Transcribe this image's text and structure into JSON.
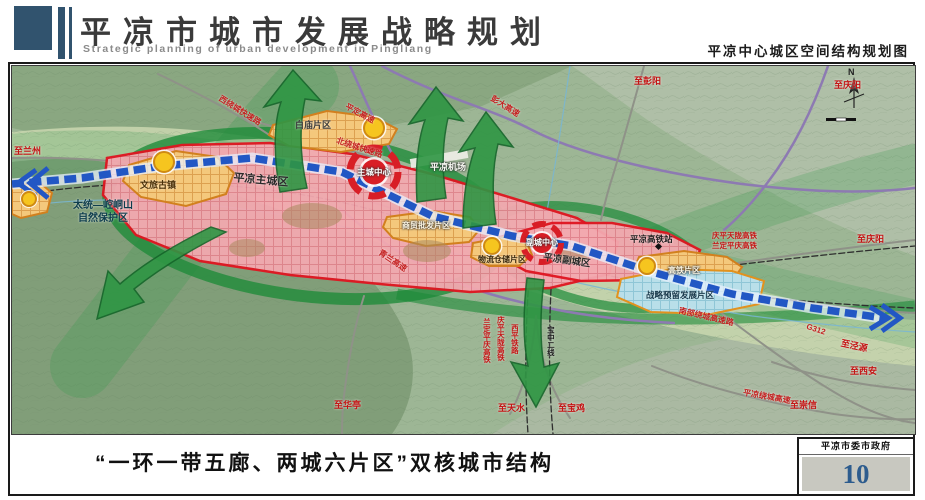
{
  "header": {
    "title": "平凉市城市发展战略规划",
    "subtitle": "Strategic planning of urban development in Pingliang",
    "map_title": "平凉中心城区空间结构规划图"
  },
  "footer": {
    "caption": "“一环一带五廊、两城六片区”双核城市结构",
    "agency": "平凉市委市政府",
    "page_number": "10"
  },
  "map": {
    "compass_n": "N",
    "colors": {
      "header_accent": "#31536e",
      "page_number_blue": "#2d5c8e",
      "main_city_border": "#e01520",
      "district_border": "#d2801e",
      "reserve_fill": "#b9dfe9",
      "axis_blue": "#2257c4",
      "corridor_green": "#2f9644",
      "node_yellow": "#f6c51f"
    },
    "labels": [
      {
        "text": "至兰州",
        "x": 2,
        "y": 80,
        "color": "#c41414",
        "size": 9
      },
      {
        "text": "太统—崆峒山\n自然保护区",
        "x": 48,
        "y": 134,
        "color": "#0e3d4d",
        "size": 10,
        "width": 86,
        "center": 1
      },
      {
        "text": "文旅古镇",
        "x": 128,
        "y": 114,
        "color": "#4a3008",
        "size": 9
      },
      {
        "text": "平凉主城区",
        "x": 222,
        "y": 106,
        "color": "#2a2a2a",
        "size": 11,
        "rotate": 5
      },
      {
        "text": "主城中心",
        "x": 345,
        "y": 101,
        "color": "#ffffff",
        "size": 8.5,
        "halo": 1
      },
      {
        "text": "白庙片区",
        "x": 283,
        "y": 54,
        "color": "#3c3c3c",
        "size": 9
      },
      {
        "text": "西绕城快速路",
        "x": 210,
        "y": 28,
        "color": "#c42020",
        "size": 8,
        "rotate": 32
      },
      {
        "text": "平定高速",
        "x": 336,
        "y": 36,
        "color": "#c42020",
        "size": 8,
        "rotate": 28
      },
      {
        "text": "北绕城快速路",
        "x": 326,
        "y": 70,
        "color": "#c42020",
        "size": 8,
        "rotate": 18
      },
      {
        "text": "彭大高速",
        "x": 482,
        "y": 28,
        "color": "#c42020",
        "size": 8,
        "rotate": 32
      },
      {
        "text": "平凉机场",
        "x": 418,
        "y": 96,
        "color": "#f8f8f2",
        "size": 9,
        "halo": 1
      },
      {
        "text": "青兰高速",
        "x": 370,
        "y": 182,
        "color": "#c42020",
        "size": 8,
        "rotate": 34
      },
      {
        "text": "商贸批发片区",
        "x": 390,
        "y": 155,
        "color": "#fdf6e2",
        "size": 8,
        "halo": 1
      },
      {
        "text": "物流仓储片区",
        "x": 466,
        "y": 189,
        "color": "#38280c",
        "size": 8
      },
      {
        "text": "副城中心",
        "x": 514,
        "y": 172,
        "color": "#ffffff",
        "size": 8,
        "halo": 1
      },
      {
        "text": "平凉副城区",
        "x": 532,
        "y": 186,
        "color": "#2a2a2a",
        "size": 9.5,
        "rotate": 8
      },
      {
        "text": "平凉高铁站",
        "x": 618,
        "y": 168,
        "color": "#1c1c1c",
        "size": 8.5
      },
      {
        "text": "庆平天陇高铁",
        "x": 700,
        "y": 165,
        "color": "#c41414",
        "size": 7.5
      },
      {
        "text": "兰定平庆高铁",
        "x": 700,
        "y": 175,
        "color": "#c41414",
        "size": 7.5
      },
      {
        "text": "至彭阳",
        "x": 622,
        "y": 10,
        "color": "#c41414",
        "size": 9
      },
      {
        "text": "至庆阳",
        "x": 822,
        "y": 14,
        "color": "#c41414",
        "size": 9
      },
      {
        "text": "至庆阳",
        "x": 845,
        "y": 168,
        "color": "#c41414",
        "size": 9
      },
      {
        "text": "高铁片区",
        "x": 656,
        "y": 200,
        "color": "#fdf6e2",
        "size": 8,
        "halo": 1
      },
      {
        "text": "战略预留发展片区",
        "x": 634,
        "y": 224,
        "color": "#17384a",
        "size": 8.5
      },
      {
        "text": "南部绕城高速路",
        "x": 668,
        "y": 240,
        "color": "#c42020",
        "size": 8,
        "rotate": 13
      },
      {
        "text": "G312",
        "x": 796,
        "y": 256,
        "color": "#c42020",
        "size": 8,
        "rotate": 18
      },
      {
        "text": "至泾源",
        "x": 830,
        "y": 272,
        "color": "#c41414",
        "size": 9,
        "rotate": 12
      },
      {
        "text": "至西安",
        "x": 838,
        "y": 300,
        "color": "#c41414",
        "size": 9
      },
      {
        "text": "平凉绕城高速",
        "x": 732,
        "y": 322,
        "color": "#c42020",
        "size": 8,
        "rotate": 10
      },
      {
        "text": "至崇信",
        "x": 778,
        "y": 334,
        "color": "#c41414",
        "size": 9
      },
      {
        "text": "至华亭",
        "x": 322,
        "y": 334,
        "color": "#c41414",
        "size": 9
      },
      {
        "text": "至天水",
        "x": 486,
        "y": 337,
        "color": "#c41414",
        "size": 9
      },
      {
        "text": "至宝鸡",
        "x": 546,
        "y": 337,
        "color": "#c41414",
        "size": 9
      },
      {
        "text": "兰定平庆高铁",
        "x": 470,
        "y": 252,
        "color": "#c41414",
        "size": 7.5,
        "vertical": 1
      },
      {
        "text": "庆平天陇高铁",
        "x": 484,
        "y": 250,
        "color": "#c41414",
        "size": 7.5,
        "vertical": 1
      },
      {
        "text": "西平铁路",
        "x": 498,
        "y": 258,
        "color": "#c41414",
        "size": 7.5,
        "vertical": 1
      },
      {
        "text": "宝中二线",
        "x": 534,
        "y": 260,
        "color": "#1c1c1c",
        "size": 7.5,
        "vertical": 1
      }
    ]
  }
}
